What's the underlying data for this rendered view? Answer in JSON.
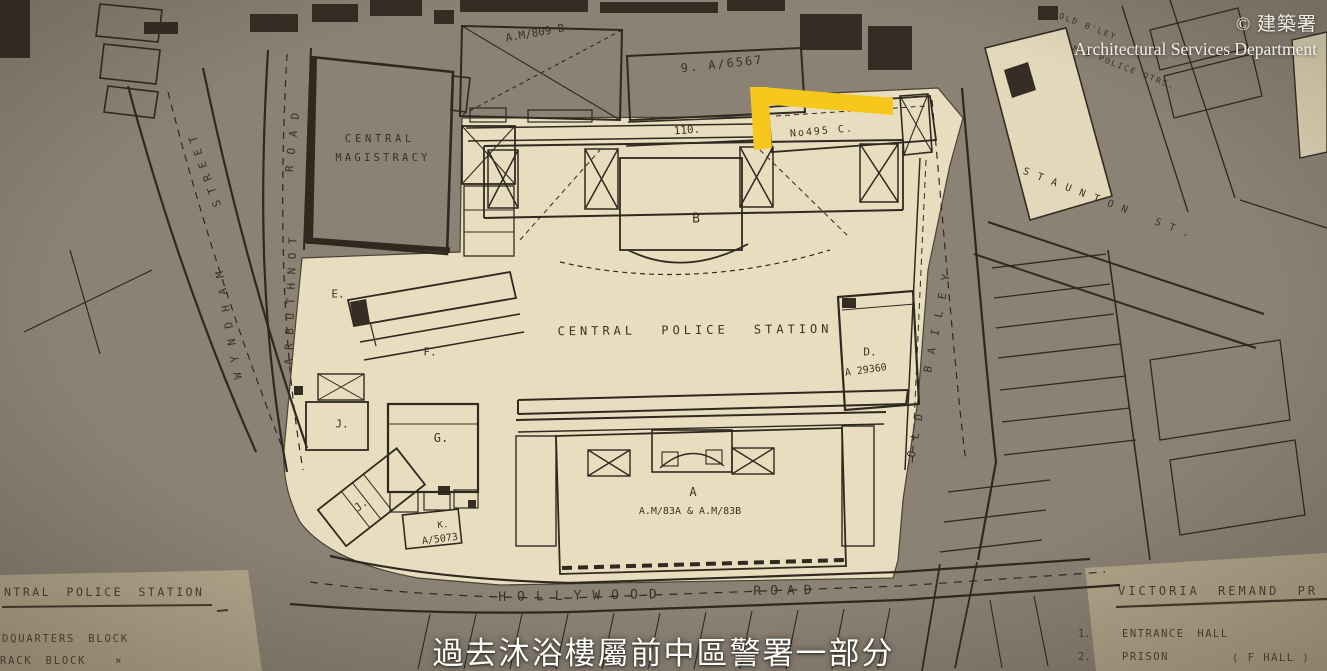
{
  "frame": {
    "copyright_cn": "© 建築署",
    "copyright_en": "Architectural Services Department",
    "subtitle": "過去沐浴樓屬前中區警署一部分"
  },
  "map": {
    "titles": {
      "cps": "CENTRAL POLICE STATION",
      "mag1": "CENTRAL",
      "mag2": "MAGISTRACY"
    },
    "roads": {
      "hollywood": "HOLLYWOOD",
      "hollywood2": "ROAD",
      "arbuthnot": "ARBUTHNOT",
      "arbuthnot2": "ROAD",
      "wyndham": "WYNDHAM",
      "wyndham2": "STREET",
      "old_bailey": "OLD BAILEY",
      "staunton": "STAUNTON ST."
    },
    "notes": {
      "am809": "A.M/809 B",
      "a6567": "9. A/6567",
      "n110": "110.",
      "no495": "No495 C.",
      "block_b": "B",
      "block_d": "D.",
      "a29360": "A 29360",
      "block_e": "E.",
      "block_f": "F.",
      "block_g": "G.",
      "block_j1": "J.",
      "block_j2": "J.",
      "block_k": "K.",
      "a5073": "A/5073",
      "block_a": "A",
      "am83": "A.M/83A & A.M/83B",
      "qtrs1": "OLD B'LEY",
      "qtrs2": "M'D POLICE QTRS."
    },
    "legend_left": {
      "title": "NTRAL POLICE STATION",
      "item1": "DQUARTERS BLOCK",
      "item2": "RACK BLOCK",
      "mark": "×"
    },
    "legend_right": {
      "title": "VICTORIA REMAND PR",
      "item1_no": "1.",
      "item1": "ENTRANCE HALL",
      "item2_no": "2.",
      "item2": "PRISON",
      "item2_note": "( F HALL )"
    }
  },
  "colors": {
    "map_gray": "#8b8174",
    "compound_cream": "#e8debf",
    "legend_tan": "#b4a68c",
    "ink": "#2f2920",
    "highlight_yellow": "#f7c71b",
    "overlay_white": "#f3f0e8"
  }
}
